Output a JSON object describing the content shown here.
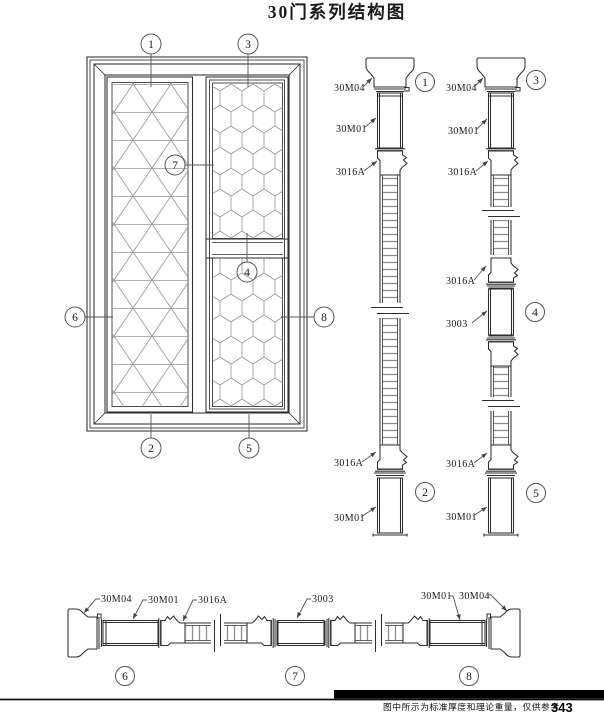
{
  "title": "30门系列结构图",
  "part_labels": {
    "cap": "30M04",
    "frame": "30M01",
    "bead": "3016A",
    "rail": "3003"
  },
  "callouts": {
    "n1": "1",
    "n2": "2",
    "n3": "3",
    "n4": "4",
    "n5": "5",
    "n6": "6",
    "n7": "7",
    "n8": "8"
  },
  "footer": {
    "note": "图中所示为标准厚度和理论重量，仅供参考",
    "page": "343"
  }
}
